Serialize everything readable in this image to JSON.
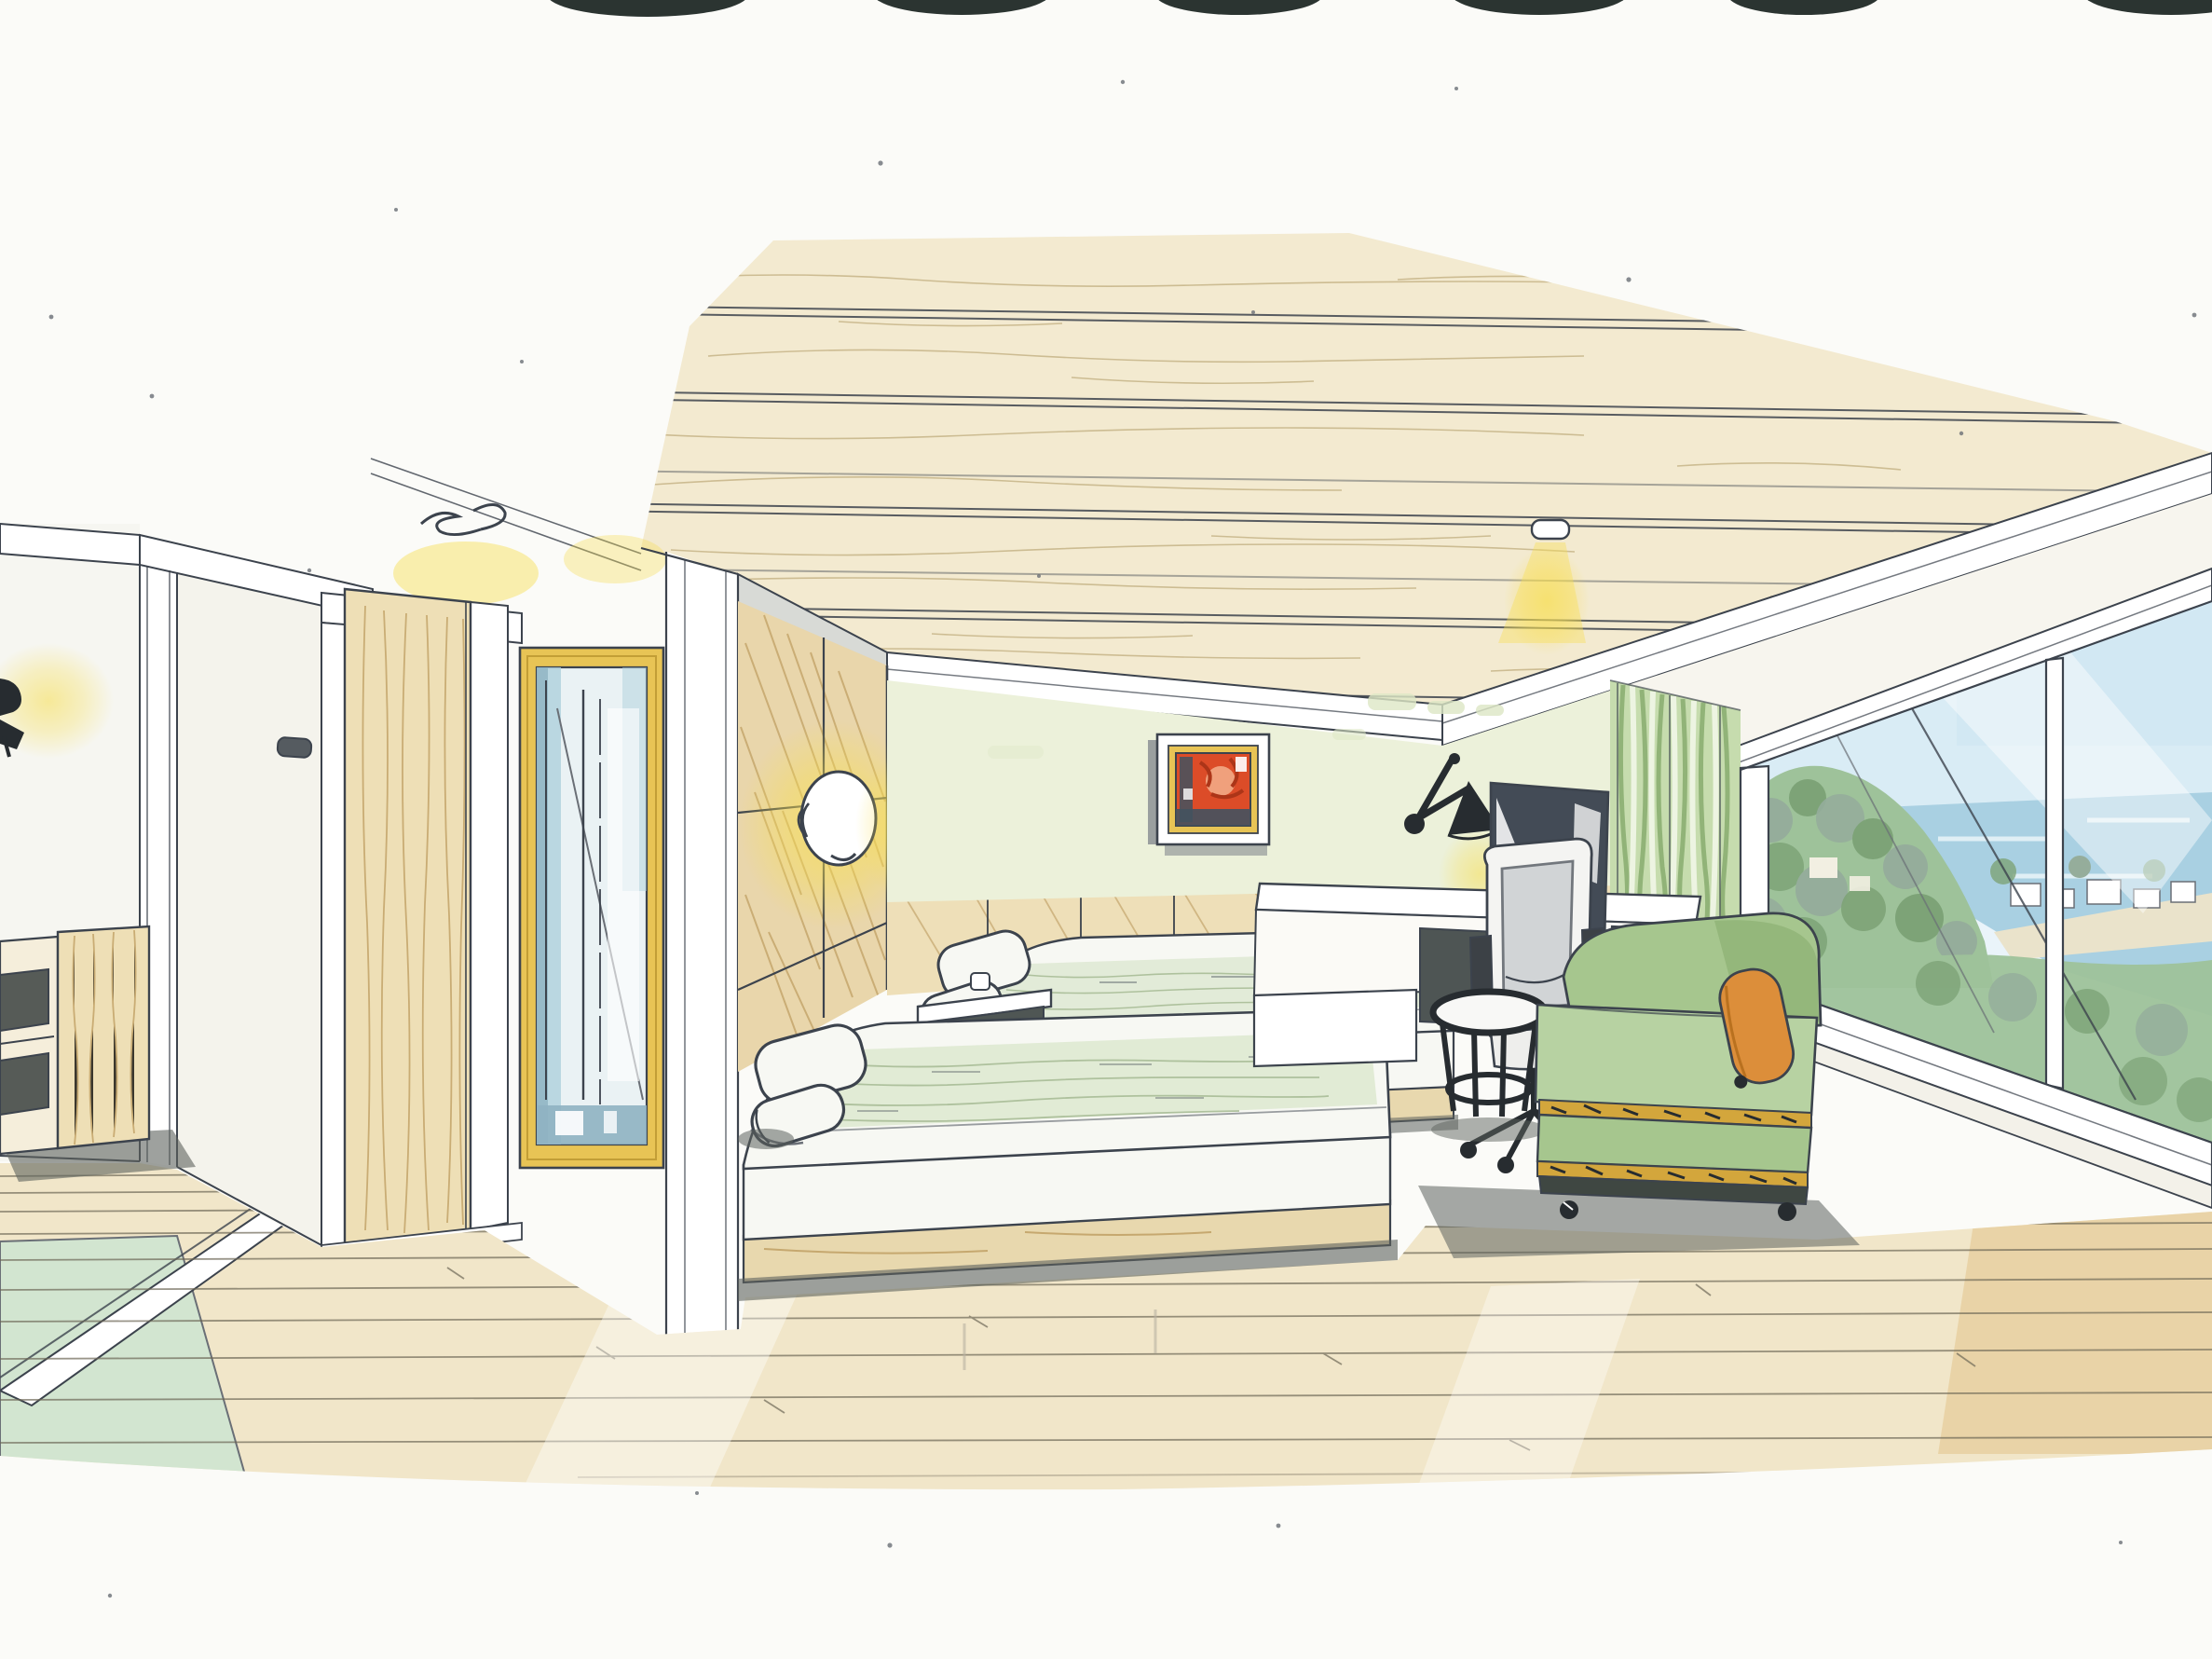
{
  "scene": {
    "type": "watercolor-interior-perspective-sketch",
    "description": "Hand-drawn ink and watercolor interior design rendering of a hotel twin-bed guestroom with wood plank ceiling, wood panelled headboard wall with two glowing round sconces, framed red abstract painting on pale green wall, wall-arm lamp, TV on white console desk with white task chair, round black side table, sage green chaise lounge with orange bolster, tall gold-framed mirror, open wooden door, and a floor-to-ceiling corner window overlooking a green coastal hillside, white houses and the sea",
    "medium": "pen, ink and watercolor on white paper",
    "artifacts": "dark scanner blobs along the top paper edge"
  },
  "objects": {
    "ceiling": "wood plank ceiling with recessed downlight",
    "downlight": "recessed ceiling downlight with yellow glow",
    "left_wall_lamp": "small black wall sconce with warm glow",
    "cabinet": "low wooden console with dark open niches",
    "door": "open light-wood door with white frame and glow above",
    "scribble": "pen scribble mark above door",
    "mirror": "tall gold-framed mirror with blue glass reflections",
    "headboard_wall": "diagonal-grain wood panel wall with two glowing round sconces",
    "painting": "red-orange abstract artwork in gold and white frame",
    "swing_lamp": "black swing-arm wall lamp",
    "tv": "flat screen TV on console",
    "desk": "white console desk with drawer unit",
    "chair": "white ergonomic swivel task chair",
    "side_table": "round black-frame side table with white top",
    "chaise": "sage green chaise lounge with gold patterned trim and orange bolster pillow",
    "beds": "two twin beds with white linens, pale green coverlets, pillows and rolled towels",
    "nightstand": "white shelf nightstand between beds",
    "curtain": "green striped sheer curtain",
    "window": "floor-to-ceiling glazing with mullions and sloping sill",
    "view": "coastal view: sky, sea, green wooded hillside and white shoreline houses",
    "floor": "light wood plank floor with pale green rug and threshold band"
  },
  "palette": {
    "paper": "#fbfbf8",
    "ink": "#3c434d",
    "inkSoft": "#6a6f76",
    "ceilWood": "#f3ead0",
    "ceilGrain": "#c3b183",
    "wood": "#e9d6ab",
    "woodDark": "#c9a96b",
    "woodGrain": "#bd9c5f",
    "doorWood": "#eedfb6",
    "floor": "#f1e6c9",
    "floorLine": "#6e6757",
    "floorWarm": "#e6cc9b",
    "wallGreen": "#ecf1da",
    "wallStreak": "#dde7c5",
    "white": "#ffffff",
    "grayShade": "#d8dad6",
    "gold": "#e8c455",
    "goldDark": "#c29e36",
    "mirrorGlass": "#eaf2f4",
    "mirrorBlue": "#aecfdc",
    "mirrorDeep": "#8fb3c2",
    "glow": "#f7de52",
    "glowSoft": "#fbeda0",
    "red": "#dc4c28",
    "redDark": "#ac3518",
    "navy": "#42525f",
    "tv": "#434b56",
    "black": "#272c30",
    "chairGray": "#c3c7cb",
    "chaise": "#a6c68e",
    "chaiseDark": "#88ad6e",
    "chaiseLight": "#b7d2a2",
    "orange": "#dc8e3a",
    "trimGold": "#d3a63c",
    "shadow": "#5d635e",
    "bedWhite": "#f7f8f3",
    "blanket": "#dee9d2",
    "blanketStroke": "#a9bd97",
    "sky": "#d9ecf5",
    "skyLight": "#eaf4fa",
    "sea": "#a9d0e2",
    "hill": "#9ec29a",
    "hillDark": "#7da377",
    "hillGray": "#95ad9b",
    "shore": "#eae3cb",
    "curtain": "#c6dcae",
    "curtainDark": "#84aa6b",
    "rug": "#d2e5d0",
    "scan": "#2b3431"
  }
}
